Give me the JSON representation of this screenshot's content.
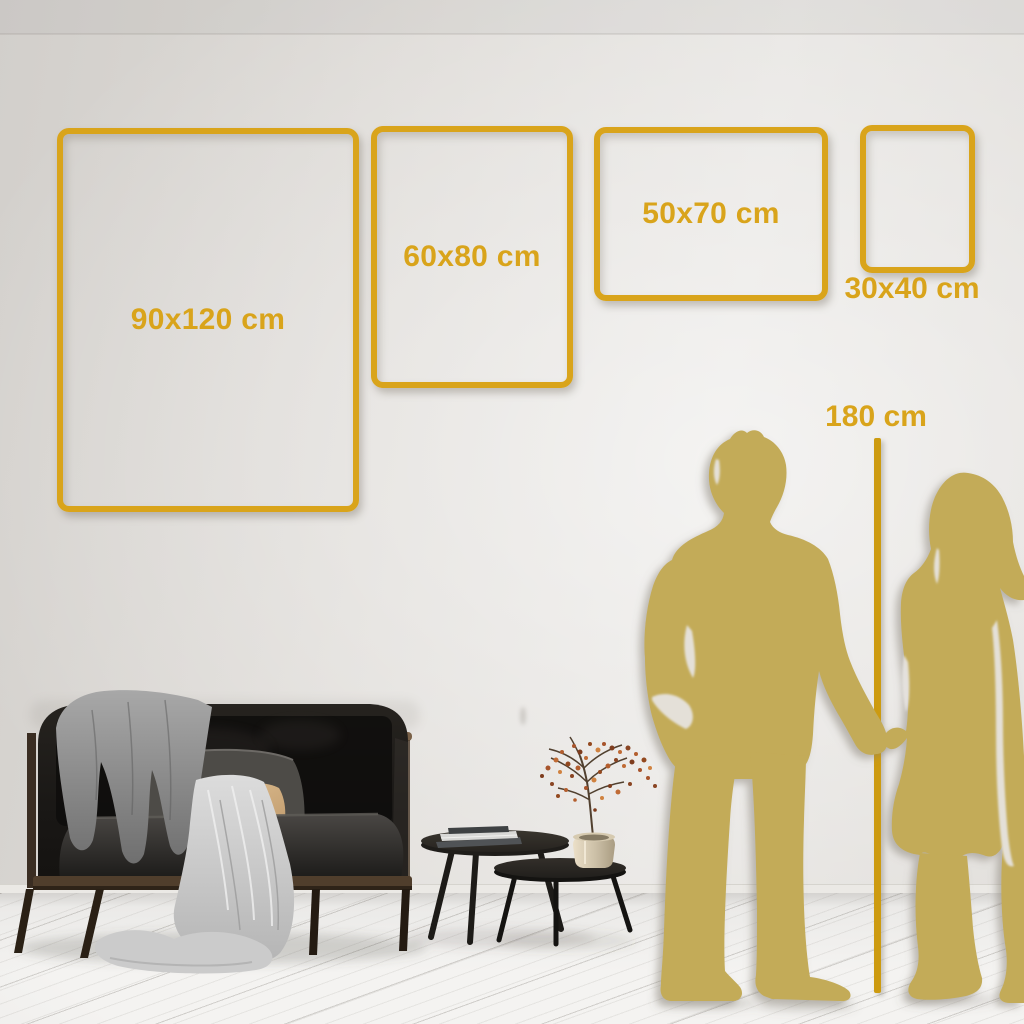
{
  "scene": {
    "type": "poster-size-guide",
    "description": "Wall size comparison guide with four gold frame outlines, a 180 cm height reference line, couple silhouettes, sofa and coffee tables"
  },
  "frames": [
    {
      "label": "90x120 cm",
      "width_cm": 90,
      "height_cm": 120
    },
    {
      "label": "60x80 cm",
      "width_cm": 60,
      "height_cm": 80
    },
    {
      "label": "50x70 cm",
      "width_cm": 50,
      "height_cm": 70
    },
    {
      "label": "30x40 cm",
      "width_cm": 30,
      "height_cm": 40
    }
  ],
  "height_marker": {
    "label": "180 cm",
    "value_cm": 180
  },
  "palette": {
    "accent_gold": "#D9A41B",
    "line_gold": "#CD9B10",
    "silhouette_gold": "#C3AB58",
    "wall": "#E3E0DC",
    "floor": "#F0EFED"
  }
}
